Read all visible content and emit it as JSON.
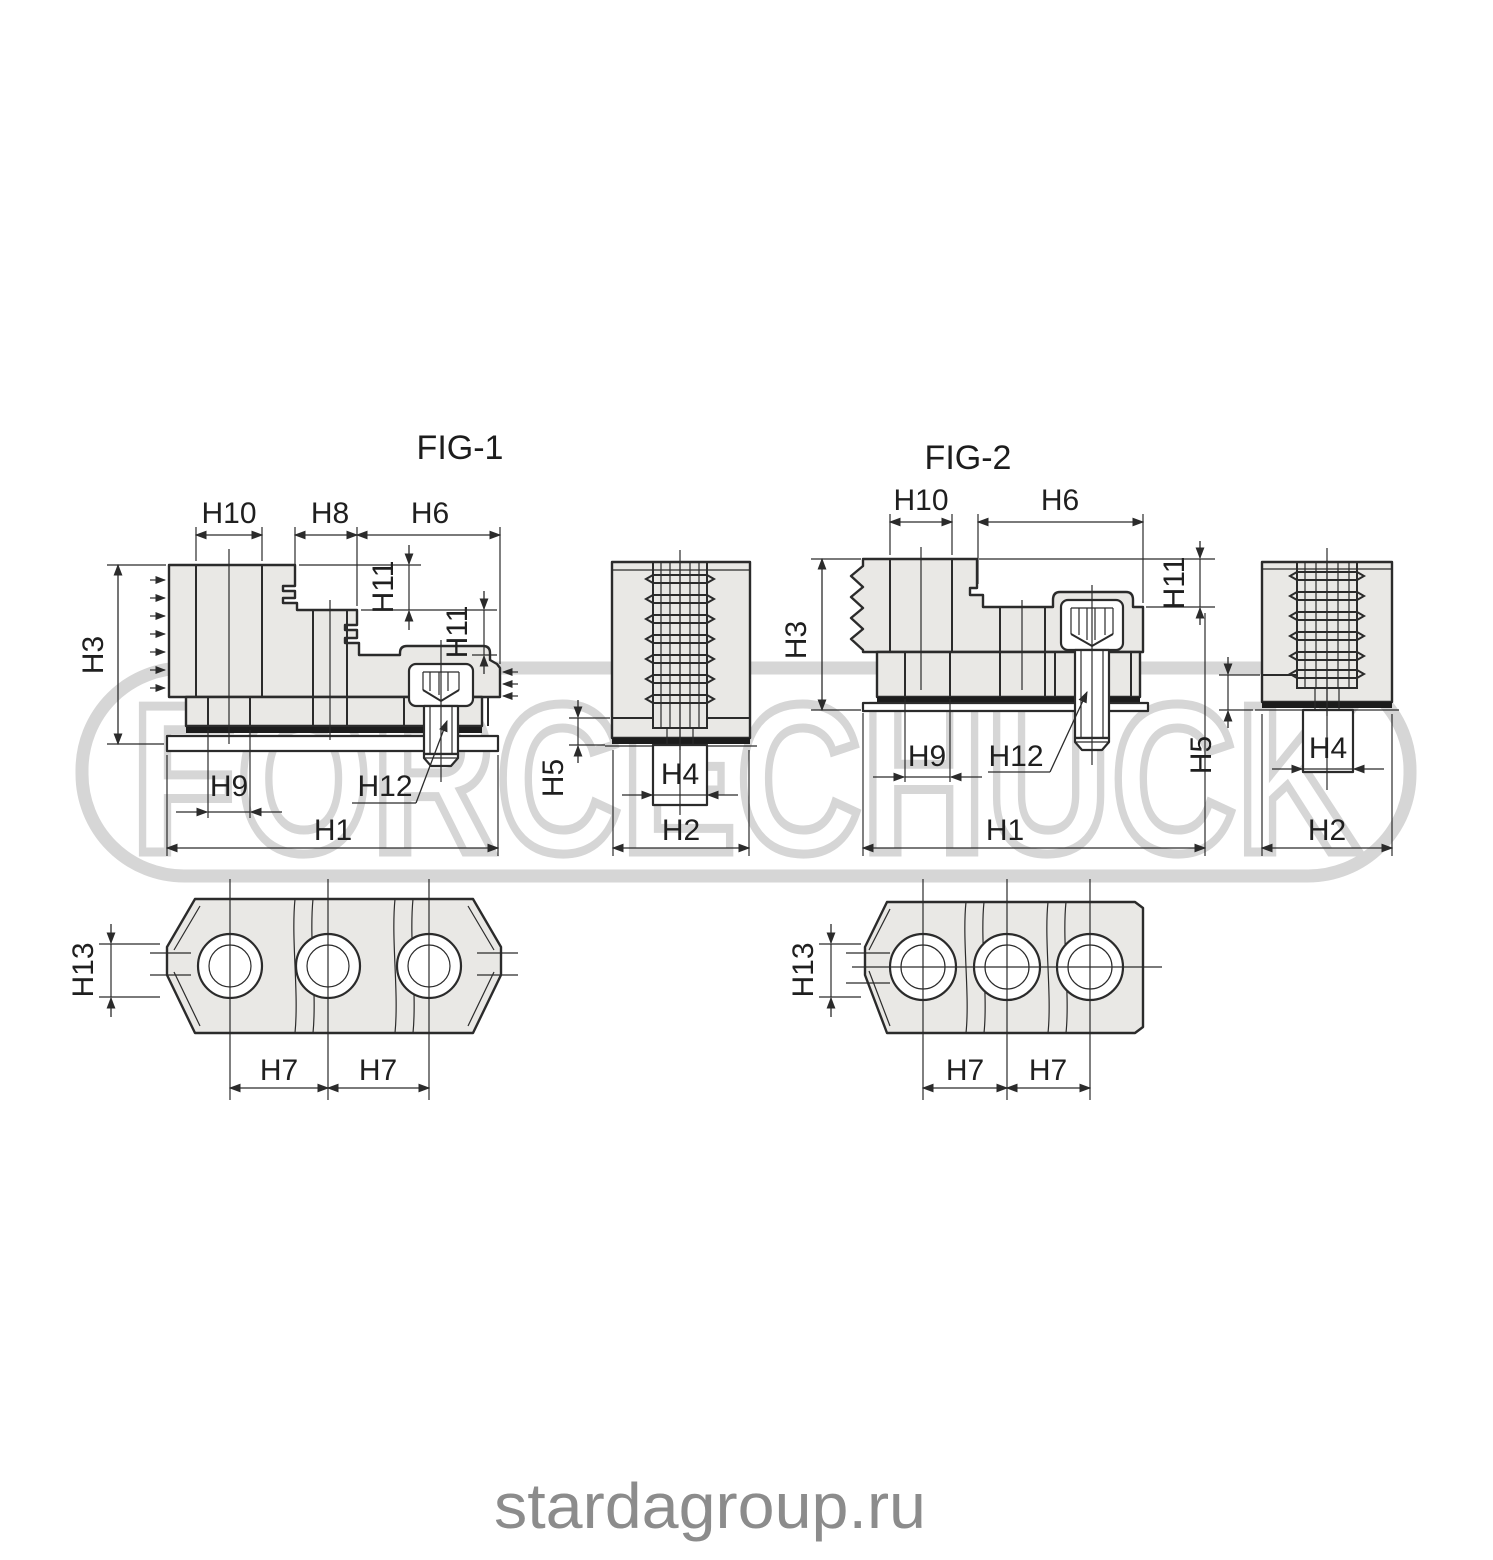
{
  "colors": {
    "line": "#2b2b2b",
    "dark": "#1c1c1c",
    "fill": "#e9e8e5",
    "watermark": "#d6d6d6",
    "footer": "#8c8c8c",
    "label": "#1f1f1f"
  },
  "watermark": {
    "text": "FORCECHUCK"
  },
  "footer": {
    "site": "stardagroup.ru"
  },
  "fig1": {
    "title": "FIG-1",
    "dims": {
      "h1": "H1",
      "h2": "H2",
      "h3": "H3",
      "h4": "H4",
      "h5": "H5",
      "h6": "H6",
      "h7": "H7",
      "h8": "H8",
      "h9": "H9",
      "h10": "H10",
      "h11": "H11",
      "h12": "H12",
      "h13": "H13"
    }
  },
  "fig2": {
    "title": "FIG-2",
    "dims": {
      "h1": "H1",
      "h2": "H2",
      "h3": "H3",
      "h4": "H4",
      "h5": "H5",
      "h6": "H6",
      "h7": "H7",
      "h9": "H9",
      "h10": "H10",
      "h11": "H11",
      "h12": "H12",
      "h13": "H13"
    }
  }
}
